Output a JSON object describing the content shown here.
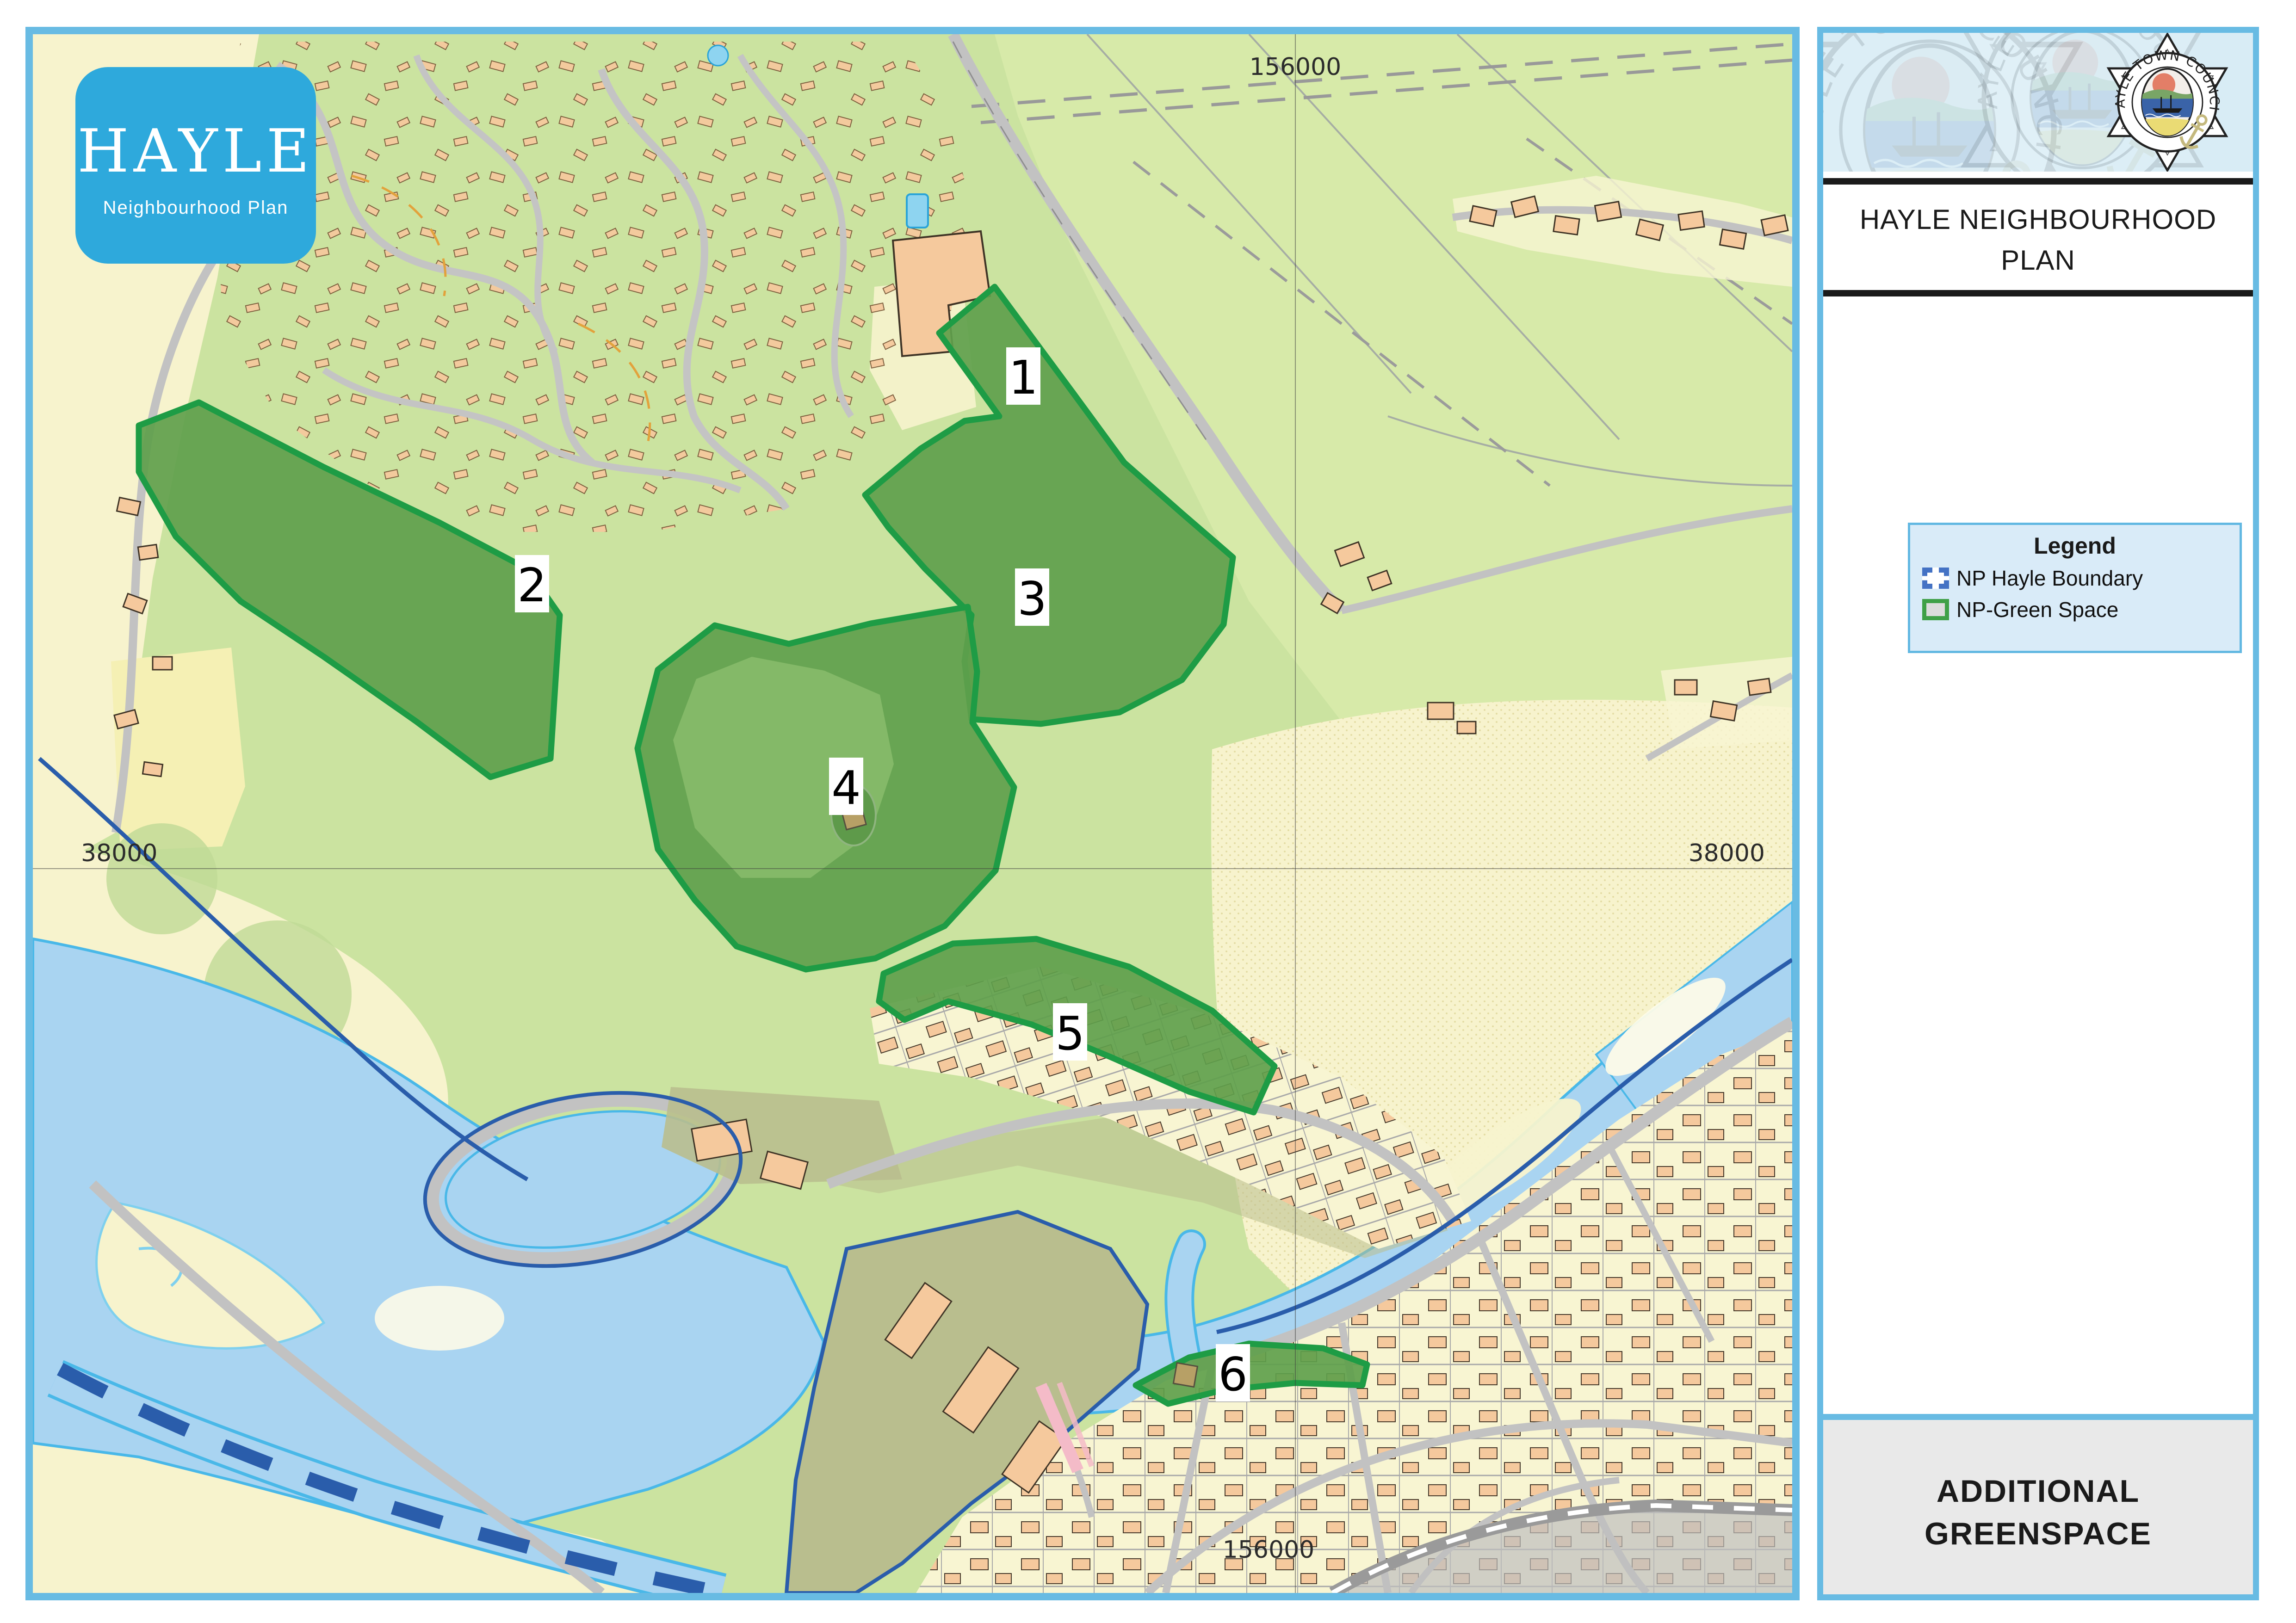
{
  "logo": {
    "title": "HAYLE",
    "subtitle": "Neighbourhood Plan"
  },
  "map": {
    "grid_labels": {
      "top": "156000",
      "bottom": "156000",
      "left": "38000",
      "right": "38000"
    },
    "greenspace_labels": [
      "1",
      "2",
      "3",
      "4",
      "5",
      "6"
    ]
  },
  "panel": {
    "crest_text": "HAYLE TOWN COUNCIL",
    "title": "HAYLE NEIGHBOURHOOD PLAN",
    "title_lines": [
      "HAYLE NEIGHBOURHOOD",
      "PLAN"
    ],
    "legend": {
      "title": "Legend",
      "items": [
        {
          "label": "NP Hayle Boundary",
          "swatch": "blue-dashed-square"
        },
        {
          "label": "NP-Green Space",
          "swatch": "green-square"
        }
      ]
    },
    "footer_lines": [
      "ADDITIONAL",
      "GREENSPACE"
    ]
  },
  "colors": {
    "frame_blue": "#68BBE3",
    "logo_blue": "#2EA9DC",
    "base_green": "#CBE3A0",
    "field_green": "#D7EAA9",
    "green_space_fill": "#5FA04C",
    "green_space_stroke": "#1E9C45",
    "boundary_blue": "#2A5DAB",
    "water_fill": "#A9D4F1",
    "water_edge": "#49B8E8",
    "sand": "#F7F3CD",
    "town_parcel": "#F8F5D2",
    "house": "#F5C99D",
    "road_gray": "#C2C2C2",
    "khaki": "#B9BE8E",
    "legend_boundary_swatch": "#4472C4",
    "legend_green_swatch": "#3FA047"
  }
}
